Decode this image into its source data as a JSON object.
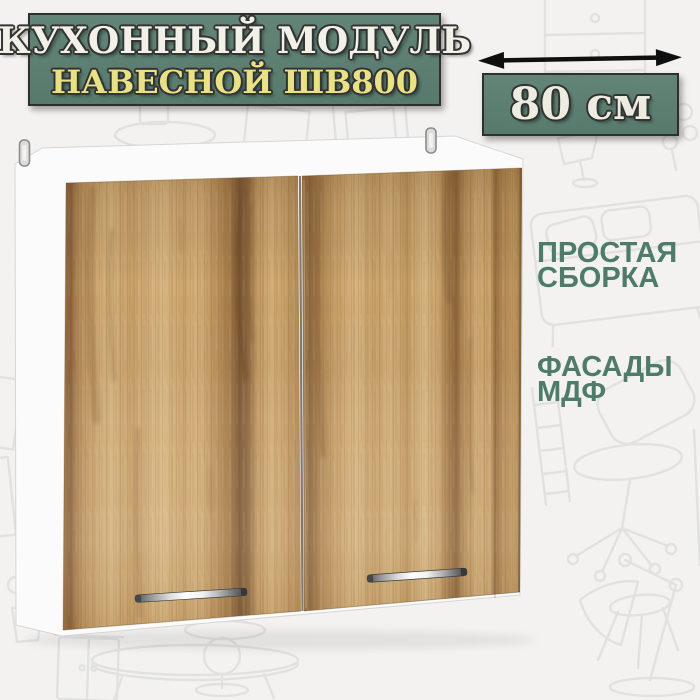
{
  "title_badge": {
    "line1": "КУХОННЫЙ МОДУЛЬ",
    "line2": "НАВЕСНОЙ ШВ800"
  },
  "dimension": {
    "label": "80 см",
    "arrow_icon": "double-headed-horizontal-arrow"
  },
  "features": [
    {
      "lines": [
        "ПРОСТАЯ",
        "СБОРКА"
      ]
    },
    {
      "lines": [
        "ФАСАДЫ",
        "МДФ"
      ]
    }
  ],
  "product_render": {
    "alt": "Навесной кухонный шкаф с двумя деревянными фасадами и хромированными ручками",
    "doors": 2,
    "handles": 2,
    "mounting_hooks": 2
  },
  "colors": {
    "background": "#f3f2f0",
    "doodle_stroke": "#e1e1e1",
    "badge_green": "#5d8073",
    "badge_border": "#2f2f2f",
    "title_text": "#f2f1e8",
    "subtitle_text": "#e8e186",
    "dimension_text": "#edece1",
    "feature_text": "#4e7b6a",
    "arrow": "#0f0f0f",
    "carcass_white": "#fbfbfb",
    "wood_light": "#d6b37d",
    "wood_dark": "#7c5832",
    "handle_chrome": "#e8e8e8"
  }
}
